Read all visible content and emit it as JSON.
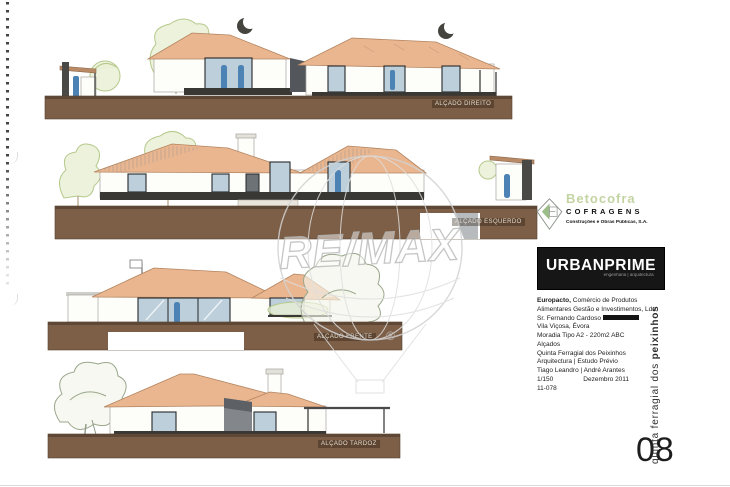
{
  "elevations": [
    {
      "label": "ALÇADO DIREITO"
    },
    {
      "label": "ALÇADO ESQUERDO"
    },
    {
      "label": "ALÇADO FRENTE"
    },
    {
      "label": "ALÇADO TARDOZ"
    }
  ],
  "watermark": {
    "brand": "RE/MAX",
    "registered": "®"
  },
  "title_block": {
    "betocofra": {
      "name": "Betocofra",
      "division": "COFRAGENS",
      "tagline": "Construções e Obras Públicas, S.A."
    },
    "urbanprime": {
      "name": "URBANPRIME",
      "tagline": "engenharia | arquitectura"
    },
    "client": {
      "bold": "Europacto,",
      "rest": " Comércio de Produtos Alimentares Gestão e Investimentos, Lda",
      "contact": "Sr. Fernando Cardoso"
    },
    "location": "Vila Viçosa, Évora",
    "project_title": "Moradia Tipo A2 - 220m2 ABC",
    "project_subtitle": "Alçados",
    "site": "Quinta Ferragial dos Peixinhos",
    "phase": "Arquitectura | Estudo Prévio",
    "authors": "Tiago Leandro | André Arantes",
    "scale": "1/150",
    "date": "Dezembro 2011",
    "reference": "11-078",
    "sheet_number": "08",
    "vertical_title": {
      "regular": "quinta ferragial dos ",
      "bold": "peixinhos"
    }
  },
  "colors": {
    "roof": "#eab690",
    "ground": "#7d5f47",
    "logo_green": "#c3d4a3",
    "figure_blue": "#4d83b4"
  }
}
